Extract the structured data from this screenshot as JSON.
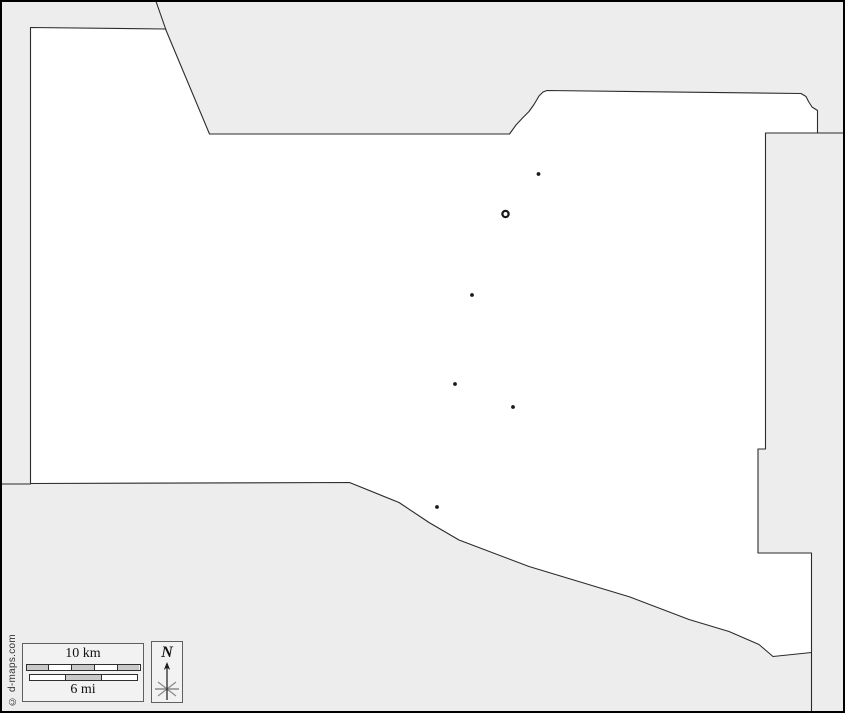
{
  "credit": "© d-maps.com",
  "legend": {
    "scale": {
      "km_label": "10 km",
      "mi_label": "6 mi",
      "km_segment_colors": [
        "#c9c9c9",
        "#ffffff",
        "#c9c9c9",
        "#ffffff",
        "#c9c9c9"
      ],
      "mi_segment_colors": [
        "#ffffff",
        "#c9c9c9",
        "#ffffff"
      ]
    },
    "north_label": "N",
    "projection": {
      "label": "Mercator",
      "arrow_glyph": "→"
    }
  },
  "map": {
    "colors": {
      "background": "#ededed",
      "land": "#ffffff",
      "boundary": "#2b2b2b",
      "frame": "#000000",
      "marker": "#1a1a1a"
    },
    "land_path": "M 30.5 27.5 L 165.5 29 L 209.5 134 L 509.5 134 L 516 125 L 523 117.5 L 529 111.5 L 534 104.5 L 539 96 L 543 92 L 547 90.5 L 801 93.5 L 806 96.5 L 808.5 101.5 L 812 107 L 817.5 110.5 L 817.5 133 L 765.5 133 L 765.5 449 L 758 449 L 758 553 L 811.5 553 L 811.5 652.5 L 773 656.5 L 759 644.5 L 729 631.5 L 689 619.5 L 630 597 L 529 566.5 L 459 540 L 429 522.5 L 399 502.5 L 349.5 482.5 L 30.5 483.5 Z",
    "neighbor_boundary_lines": [
      "M 155.5 0 L 166 30",
      "M 0 484 L 31 484",
      "M 817.5 133 L 845 133",
      "M 811.5 652.5 L 811.5 713"
    ],
    "capital_marker": {
      "x": 505.5,
      "y": 214
    },
    "town_markers": [
      {
        "x": 538.5,
        "y": 174
      },
      {
        "x": 472,
        "y": 295
      },
      {
        "x": 455,
        "y": 384
      },
      {
        "x": 513,
        "y": 407
      },
      {
        "x": 437,
        "y": 507
      }
    ]
  }
}
